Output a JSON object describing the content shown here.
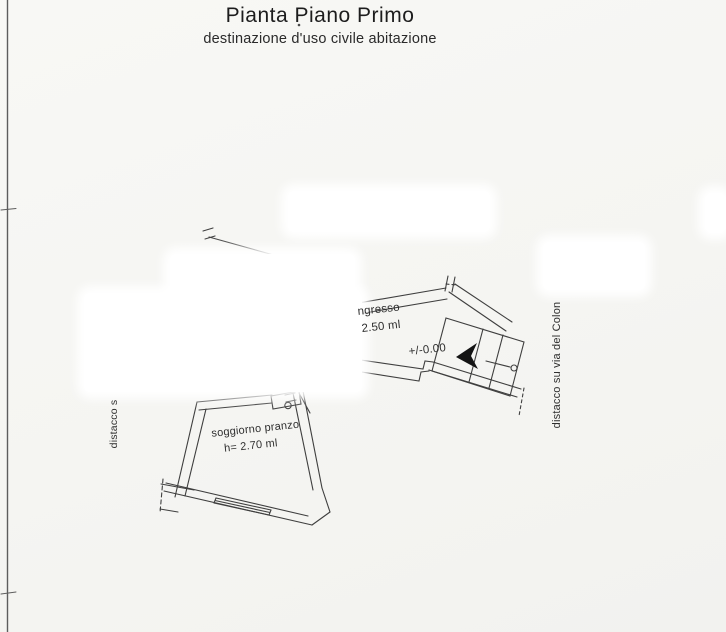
{
  "page": {
    "title": "Pianta Piano Primo",
    "subtitle": "destinazione d'uso civile abitazione"
  },
  "plan": {
    "labels": {
      "ingresso_name": "ngresso",
      "ingresso_height": "2.50 ml",
      "level_mark": "+/-0.00",
      "soggiorno_name": "soggiorno pranzo",
      "soggiorno_height": "h= 2.70 ml",
      "left_margin_note": "distacco s",
      "right_margin_note": "distacco su via del Colon"
    },
    "colors": {
      "line": "#3f3f3f",
      "ink": "#222222",
      "paper": "#f5f5f2",
      "redaction": "#ffffff"
    }
  }
}
